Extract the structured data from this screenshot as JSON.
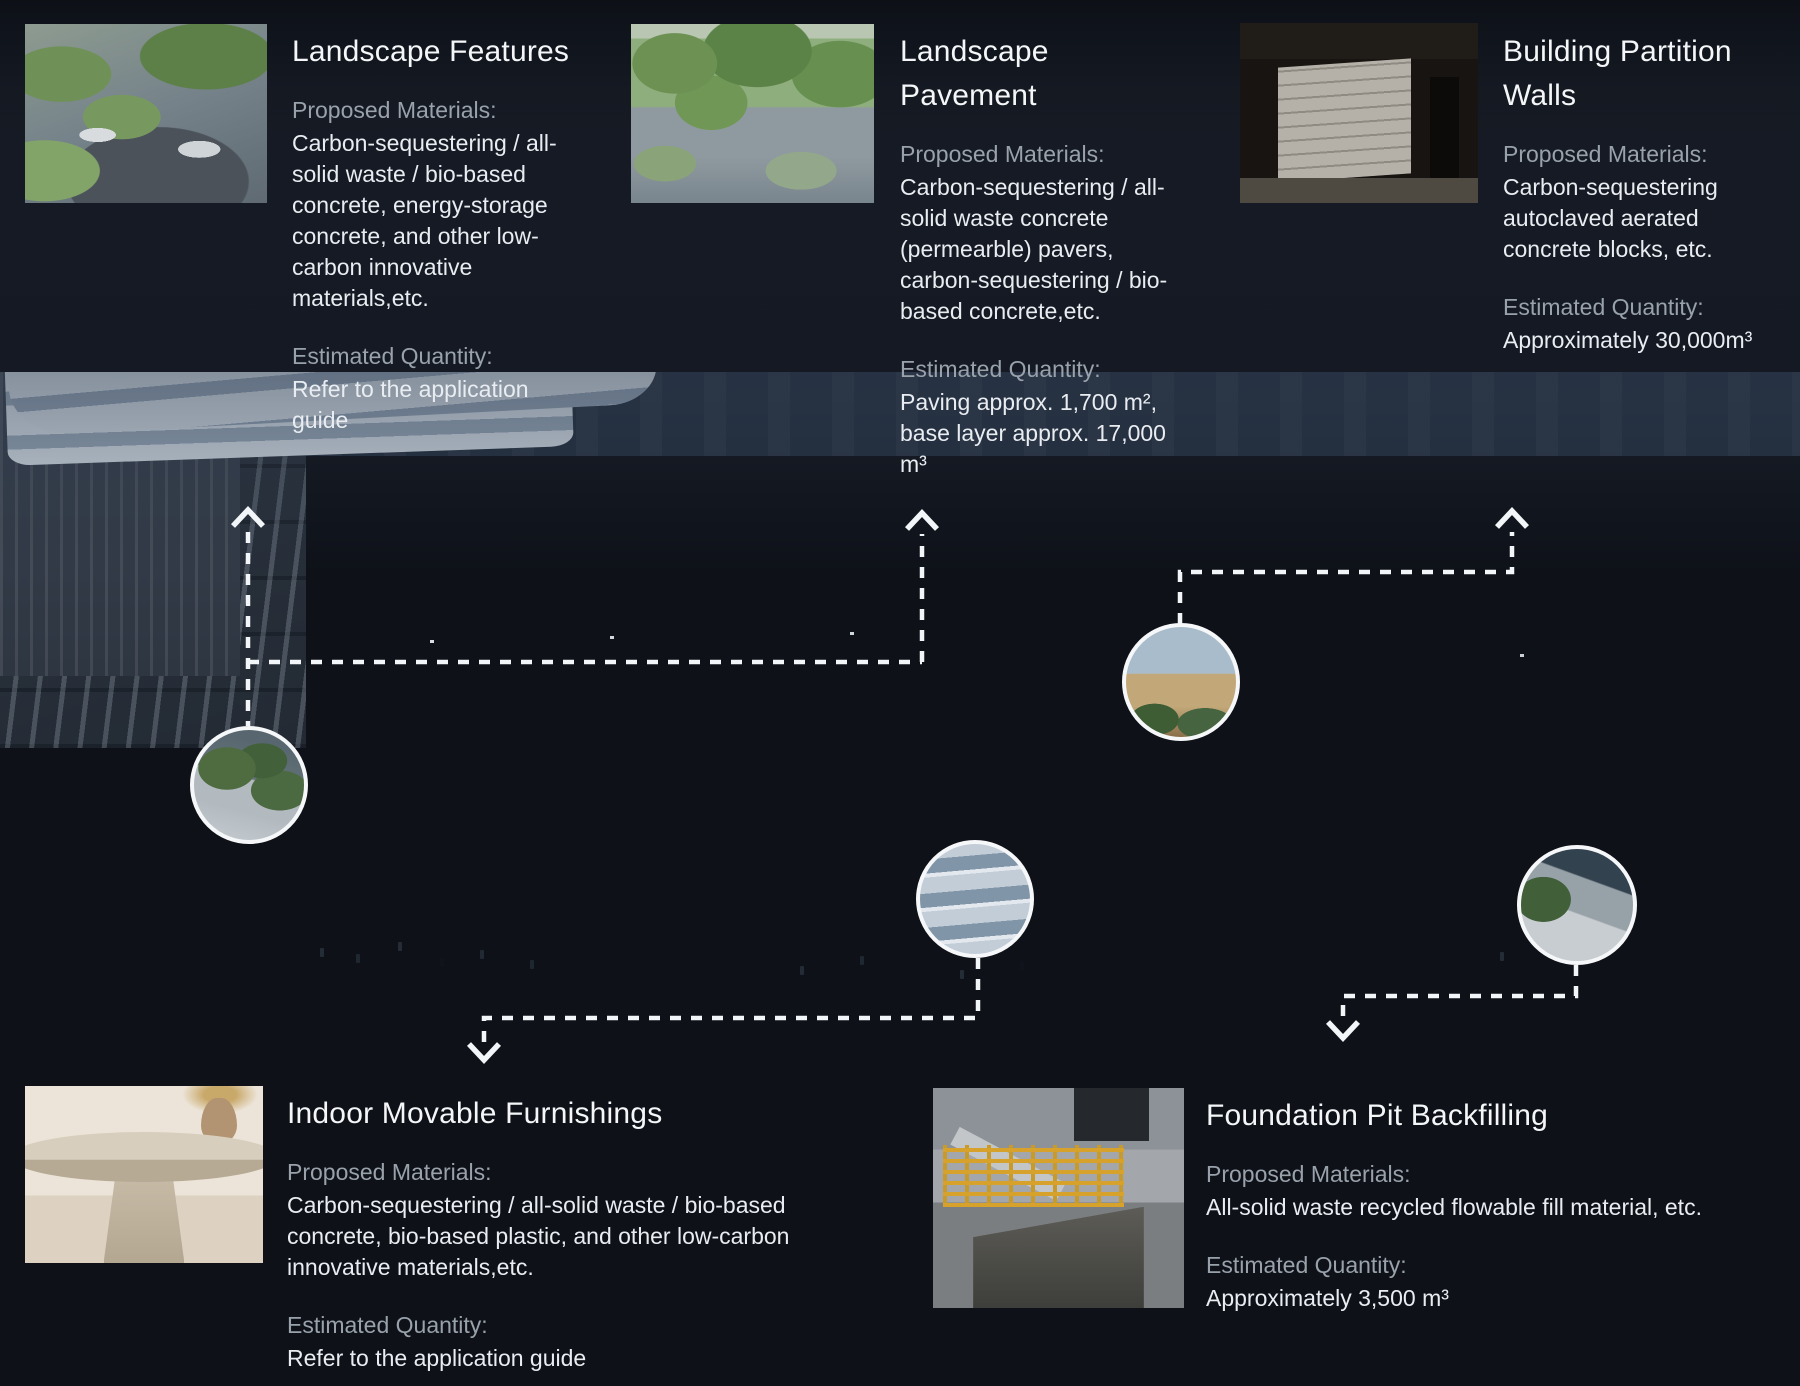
{
  "cards": [
    {
      "title": "Landscape Features",
      "materials_label": "Proposed Materials:",
      "materials": "Carbon-sequestering / all-solid waste / bio-based concrete, energy-storage concrete, and other low-carbon innovative materials,etc.",
      "quantity_label": "Estimated Quantity:",
      "quantity": "Refer to the application guide"
    },
    {
      "title": "Landscape Pavement",
      "materials_label": "Proposed Materials:",
      "materials": "Carbon-sequestering / all-solid waste concrete (permearble) pavers, carbon-sequestering / bio-based concrete,etc.",
      "quantity_label": "Estimated Quantity:",
      "quantity": "Paving approx. 1,700 m², base layer approx. 17,000 m³"
    },
    {
      "title": "Building Partition Walls",
      "materials_label": "Proposed Materials:",
      "materials": "Carbon-sequestering autoclaved aerated concrete blocks, etc.",
      "quantity_label": "Estimated Quantity:",
      "quantity": "Approximately 30,000m³"
    },
    {
      "title": "Indoor Movable Furnishings",
      "materials_label": "Proposed Materials:",
      "materials": "Carbon-sequestering / all-solid waste / bio-based concrete, bio-based plastic, and other low-carbon innovative materials,etc.",
      "quantity_label": "Estimated Quantity:",
      "quantity": "Refer to the application guide"
    },
    {
      "title": "Foundation Pit Backfilling",
      "materials_label": "Proposed Materials:",
      "materials": "All-solid waste recycled flowable fill material, etc.",
      "quantity_label": "Estimated Quantity:",
      "quantity": "Approximately 3,500 m³"
    }
  ],
  "colors": {
    "dash_line": "#f3f6f8",
    "title_text": "#f4f6f8",
    "label_text": "#99a2ab",
    "body_text": "#e9edf1",
    "overlay_dark": "#14181f",
    "roof_green": "#5e7c46"
  }
}
